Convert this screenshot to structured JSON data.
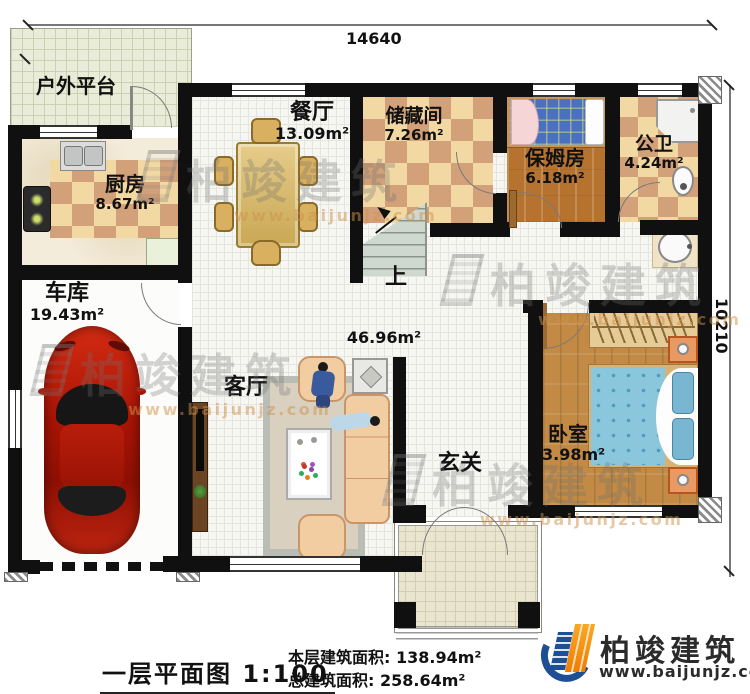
{
  "dimensions": {
    "top": "14640",
    "right": "10210"
  },
  "rooms": {
    "platform": {
      "name": "户外平台"
    },
    "kitchen": {
      "name": "厨房",
      "area": "8.67m²"
    },
    "dining": {
      "name": "餐厅",
      "area": "13.09m²"
    },
    "storage": {
      "name": "储藏间",
      "area": "7.26m²"
    },
    "nanny": {
      "name": "保姆房",
      "area": "6.18m²"
    },
    "bath": {
      "name": "公卫",
      "area": "4.24m²"
    },
    "garage": {
      "name": "车库",
      "area": "19.43m²"
    },
    "living": {
      "name": "客厅",
      "area": "46.96m²"
    },
    "foyer": {
      "name": "玄关"
    },
    "bedroom": {
      "name": "卧室",
      "area": "13.98m²"
    },
    "stairs": {
      "direction_label": "上"
    }
  },
  "title_block": {
    "plan_name": "一层平面图",
    "scale": "1:100",
    "floor_area_label": "本层建筑面积:",
    "floor_area_value": "138.94m²",
    "total_area_label": "总建筑面积:",
    "total_area_value": "258.64m²"
  },
  "brand": {
    "name": "柏竣建筑",
    "website": "www.baijunjz.com"
  },
  "watermark": {
    "text": "柏竣建筑",
    "website": "www.baijunjz.com"
  },
  "colors": {
    "wall": "#101010",
    "checker_light": "#f2d9a4",
    "checker_dark": "#d2a179",
    "wood": "#b5732f",
    "bed_blue": "#7ec4dc",
    "car_red": "#c41e0e",
    "brand_blue": "#1d4f94",
    "brand_orange": "#f7941d"
  }
}
